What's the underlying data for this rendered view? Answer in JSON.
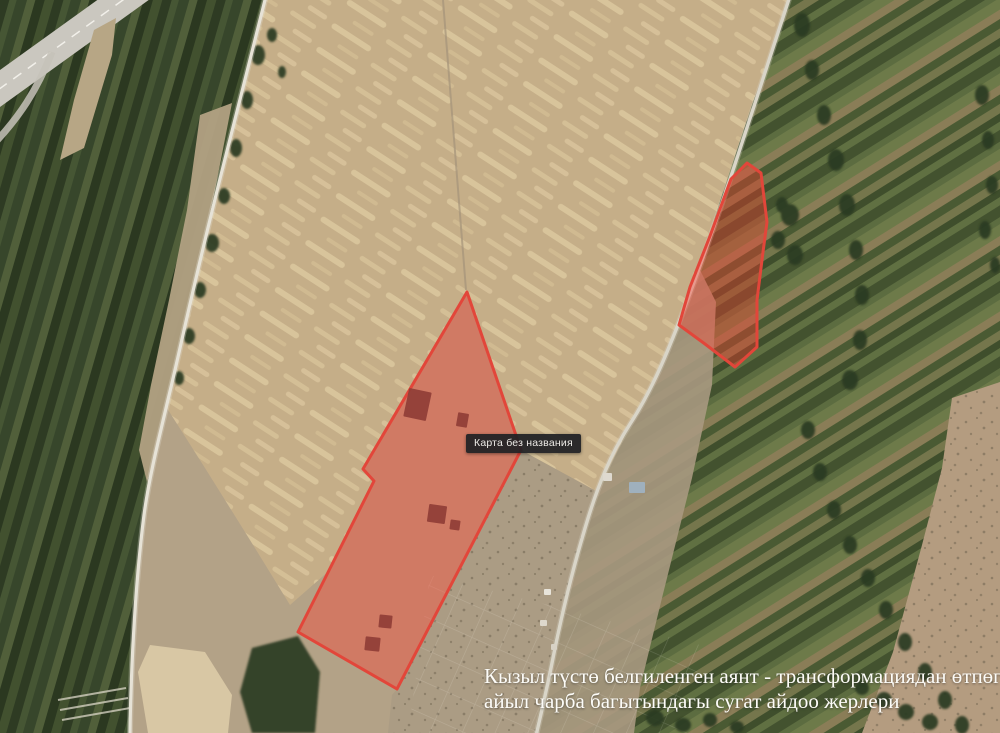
{
  "map": {
    "type": "satellite-imagery",
    "tooltip": {
      "label": "Карта без названия"
    },
    "caption": {
      "line1": "Кызыл түстө белгиленген аянт - трансформациядан өтпөгөн,",
      "line2": "айыл чарба багытындагы сугат айдоо жерлери",
      "color": "#fdfcf8"
    },
    "overlay": {
      "fill_color": "#ff3b2e",
      "fill_opacity": "0.38",
      "stroke_color": "#e2463a",
      "stroke_width": "3",
      "parcels": [
        {
          "name": "large-parcel",
          "points": "467,292 521,450 397,689 298,632 374,481 363,469"
        },
        {
          "name": "small-parcel",
          "points": "747,163 761,173 767,222 763,252 757,300 757,347 735,367 705,344 679,325 690,287 710,236 731,179"
        }
      ],
      "building_color": "#8f3d36",
      "parcel_buildings": [
        {
          "x": 406,
          "y": 390,
          "w": 23,
          "h": 29,
          "r": 12
        },
        {
          "x": 457,
          "y": 413,
          "w": 11,
          "h": 14,
          "r": 10
        },
        {
          "x": 428,
          "y": 505,
          "w": 18,
          "h": 18,
          "r": 8
        },
        {
          "x": 450,
          "y": 520,
          "w": 10,
          "h": 10,
          "r": 8
        },
        {
          "x": 379,
          "y": 615,
          "w": 13,
          "h": 13,
          "r": 6
        },
        {
          "x": 365,
          "y": 637,
          "w": 15,
          "h": 14,
          "r": 6
        }
      ]
    },
    "village_buildings": [
      {
        "x": 603,
        "y": 473,
        "w": 9,
        "h": 8,
        "c": "#ded9cf"
      },
      {
        "x": 629,
        "y": 482,
        "w": 16,
        "h": 11,
        "c": "#9fb0bd"
      },
      {
        "x": 544,
        "y": 589,
        "w": 7,
        "h": 6,
        "c": "#e8e4da"
      },
      {
        "x": 540,
        "y": 620,
        "w": 7,
        "h": 6,
        "c": "#ded8cc"
      },
      {
        "x": 551,
        "y": 644,
        "w": 6,
        "h": 6,
        "c": "#d8d2c6"
      }
    ]
  }
}
